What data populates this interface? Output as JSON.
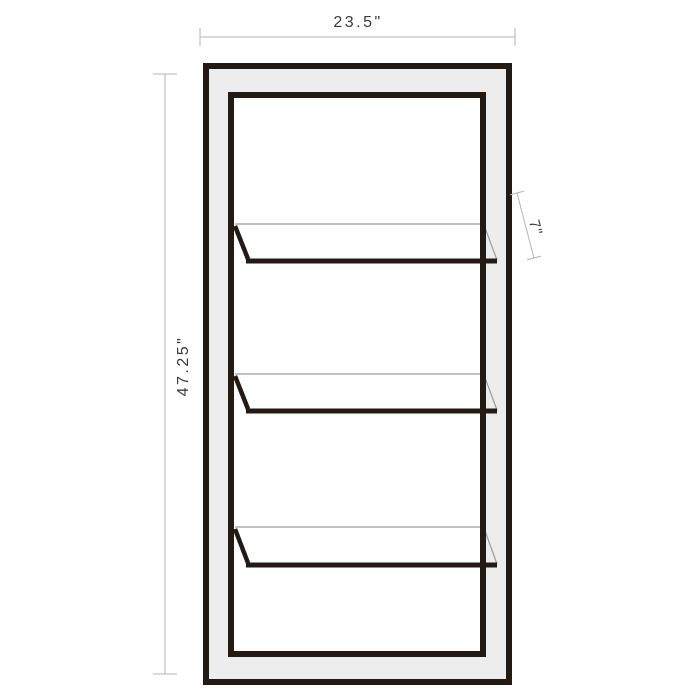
{
  "diagram": {
    "type": "furniture-dimension-drawing",
    "subject": "bookcase-front-view",
    "shelf_count": 3,
    "dimensions": {
      "width_label": "23.5\"",
      "height_label": "47.25\"",
      "shelf_depth_label": "7\""
    },
    "colors": {
      "background": "#ffffff",
      "frame": "#241a14",
      "frame_fill": "#ededed",
      "shelf_thin_line": "#9c9c9c",
      "dimension_line": "#b3b3b3",
      "dimension_text": "#3c3c3c"
    }
  }
}
